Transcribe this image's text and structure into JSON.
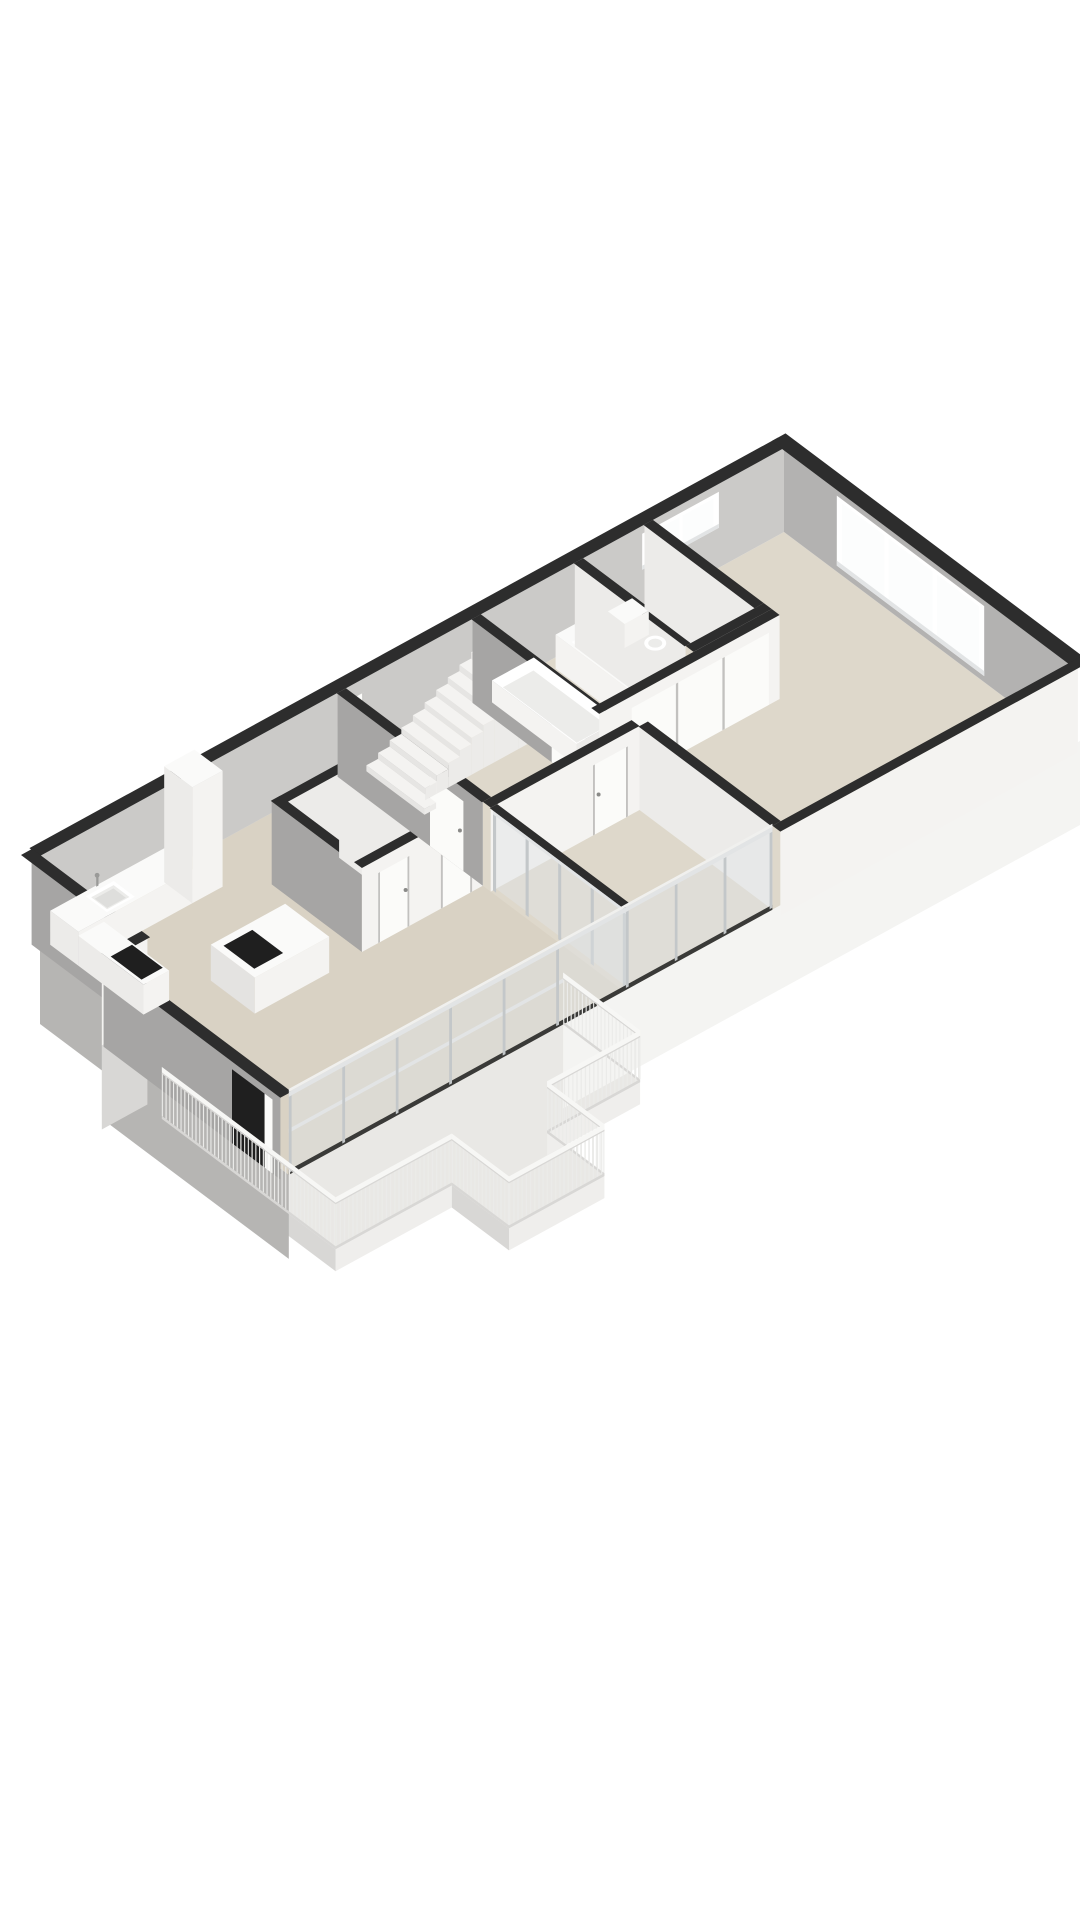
{
  "scene": {
    "type": "3d-floorplan-render",
    "background": "#ffffff",
    "description": "Isometric cutaway 3D floor plan of an apartment, no text labels"
  },
  "palette": {
    "bg": "#ffffff",
    "cap": "#2d2d2d",
    "floorMain": "#d9d2c4",
    "floorLight": "#ded8cb",
    "floorBalcony": "#e9e8e5",
    "slabWhite": "#f4f4f2",
    "slabGray": "#b6b5b3",
    "fasciaLight": "#efeeec",
    "fasciaShade": "#d8d7d5",
    "wallWhite": "#f4f3f1",
    "wallSoft": "#ecebe9",
    "wallBack": "#cbcac8",
    "wallNE": "#b3b2b1",
    "wallGray": "#a6a5a4",
    "doorLeaf": "#fbfbf9",
    "seam": "#c2c1bf",
    "handle": "#8a8a88",
    "frame": "#c3c7c9",
    "frameLight": "#e2e4e5",
    "glass": "#dfe5e7",
    "paneBright": "#fcfdfd",
    "windowFrame": "#ffffff",
    "rail": "#ebebe9",
    "railTop": "#f7f7f5",
    "railEdge": "#d8d7d5",
    "stairTop": "#f4f3f1",
    "stairRiser": "#e6e5e3",
    "stairSide": "#ecebe9",
    "fixture": "#fafaf9",
    "fixtureInner": "#ececea",
    "darkBand": "#3a3a38",
    "black": "#1f1f1f",
    "metal": "#9a9a98"
  },
  "rooms": [
    {
      "name": "living-room"
    },
    {
      "name": "kitchen"
    },
    {
      "name": "hallway-with-stairs"
    },
    {
      "name": "middle-bedroom"
    },
    {
      "name": "bathroom"
    },
    {
      "name": "toilet-room"
    },
    {
      "name": "master-bedroom"
    },
    {
      "name": "balcony"
    }
  ],
  "fixtures": [
    {
      "name": "kitchen-sink"
    },
    {
      "name": "kitchen-island"
    },
    {
      "name": "cooktop"
    },
    {
      "name": "tall-cabinet"
    },
    {
      "name": "double-vanity"
    },
    {
      "name": "bathtub"
    },
    {
      "name": "wall-hung-toilet"
    },
    {
      "name": "staircase"
    },
    {
      "name": "balcony-railing"
    },
    {
      "name": "glass-facade"
    },
    {
      "name": "glass-partition"
    },
    {
      "name": "master-bedroom-window"
    },
    {
      "name": "toilet-high-window"
    },
    {
      "name": "kitchen-window"
    },
    {
      "name": "entry-door"
    }
  ]
}
